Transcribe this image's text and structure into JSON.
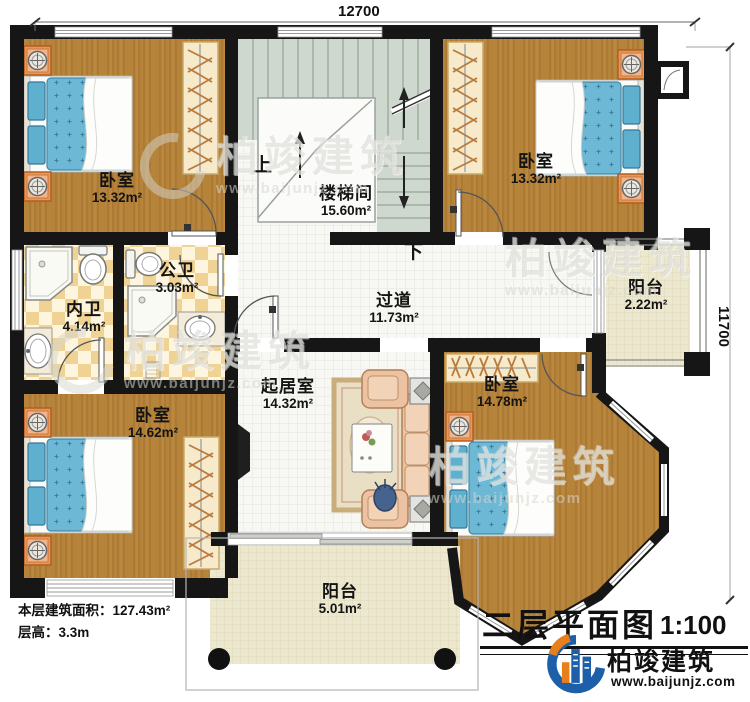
{
  "meta": {
    "title": "二层平面图",
    "scale": "1:100",
    "floor_area_label": "本层建筑面积：127.43m²",
    "floor_height_label": "层高：3.3m"
  },
  "dimensions": {
    "width": "12700",
    "height": "11700"
  },
  "rooms": [
    {
      "id": "bedroom-nw",
      "name": "卧室",
      "area": "13.32m²"
    },
    {
      "id": "stairwell",
      "name": "楼梯间",
      "area": "15.60m²"
    },
    {
      "id": "bedroom-ne",
      "name": "卧室",
      "area": "13.32m²"
    },
    {
      "id": "bath-private",
      "name": "内卫",
      "area": "4.14m²"
    },
    {
      "id": "bath-public",
      "name": "公卫",
      "area": "3.03m²"
    },
    {
      "id": "hallway",
      "name": "过道",
      "area": "11.73m²"
    },
    {
      "id": "balcony-east",
      "name": "阳台",
      "area": "2.22m²"
    },
    {
      "id": "living-room",
      "name": "起居室",
      "area": "14.32m²"
    },
    {
      "id": "bedroom-se",
      "name": "卧室",
      "area": "14.78m²"
    },
    {
      "id": "bedroom-sw",
      "name": "卧室",
      "area": "14.62m²"
    },
    {
      "id": "balcony-south",
      "name": "阳台",
      "area": "5.01m²"
    }
  ],
  "stairs": {
    "up": "上",
    "down": "下"
  },
  "branding": {
    "name": "柏竣建筑",
    "url": "www.baijunjz.com"
  },
  "colors": {
    "wall": "#161616",
    "wood_floor": "#b5833a",
    "bed_blue": "#6db8d5",
    "tile": "#f0d394",
    "stair": "#cfd8ce",
    "balcony_floor": "#ece7cf",
    "logo_blue": "#1d5fa8",
    "logo_orange": "#e87f1b"
  }
}
